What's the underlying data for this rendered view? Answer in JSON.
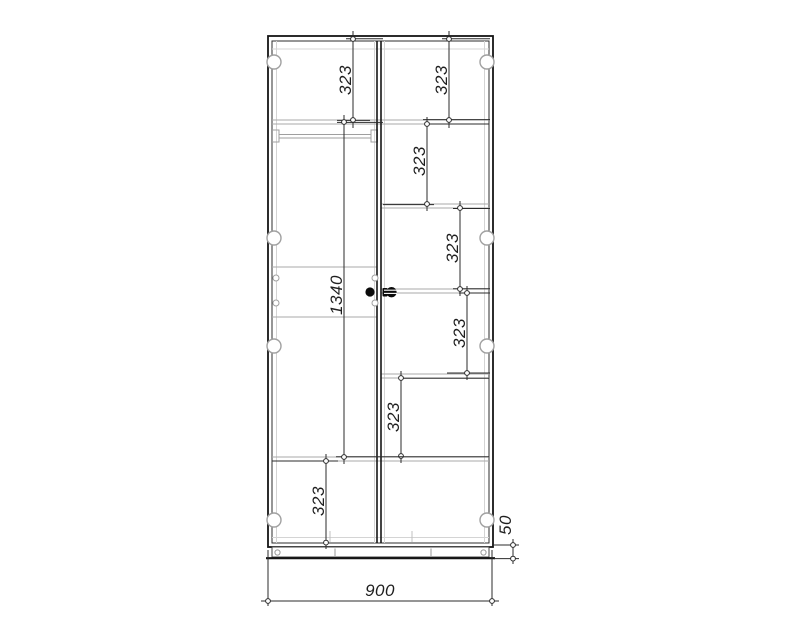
{
  "drawing": {
    "type": "furniture-technical-drawing",
    "subject": "two-door wardrobe front elevation with shelf spacing dimensions",
    "colors": {
      "outline": "#1a1a1a",
      "shelf_line": "#aaaaaa",
      "dimension_line": "#2b2b2b",
      "hardware": "#9f9f9f",
      "handle": "#0a0a0a",
      "background": "#ffffff"
    },
    "dimensions": [
      {
        "id": "left-top-compartment-height",
        "value": "323"
      },
      {
        "id": "right-top-compartment-height",
        "value": "323"
      },
      {
        "id": "right-second-compartment-height",
        "value": "323"
      },
      {
        "id": "right-third-compartment-height",
        "value": "323"
      },
      {
        "id": "right-fourth-compartment-height",
        "value": "323"
      },
      {
        "id": "right-bottom-compartment-height",
        "value": "323"
      },
      {
        "id": "left-bottom-compartment-height",
        "value": "323"
      },
      {
        "id": "left-hanging-section-height",
        "value": "1340"
      },
      {
        "id": "plinth-height",
        "value": "50"
      },
      {
        "id": "overall-width",
        "value": "900"
      }
    ]
  }
}
